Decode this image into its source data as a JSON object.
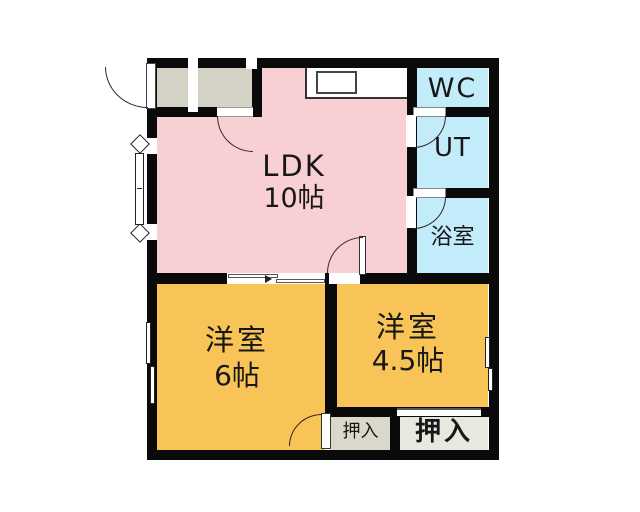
{
  "floor_plan": {
    "rooms": {
      "ldk": {
        "label": "LDK",
        "size": "10帖",
        "color": "#f8cfd3"
      },
      "wc": {
        "label": "WC",
        "color": "#c2ecf9"
      },
      "ut": {
        "label": "UT",
        "color": "#c2ecf9"
      },
      "bath": {
        "label": "浴室",
        "color": "#c2ecf9"
      },
      "western_6": {
        "label": "洋室",
        "size": "6帖",
        "color": "#f8c457"
      },
      "western_4_5": {
        "label": "洋室",
        "size": "4.5帖",
        "color": "#f8c457"
      },
      "closet_small": {
        "label": "押入",
        "color": "#d9d8ca"
      },
      "closet_large": {
        "label": "押入",
        "color": "#e9e8de"
      },
      "entrance": {
        "label": "",
        "color": "#d4d2c4"
      }
    },
    "wall_color": "#0a0a0a",
    "icons": {
      "door_swing_arc": "quarter-circle",
      "sliding_door": "offset-double-line",
      "bay_window": "flagged-window"
    }
  }
}
